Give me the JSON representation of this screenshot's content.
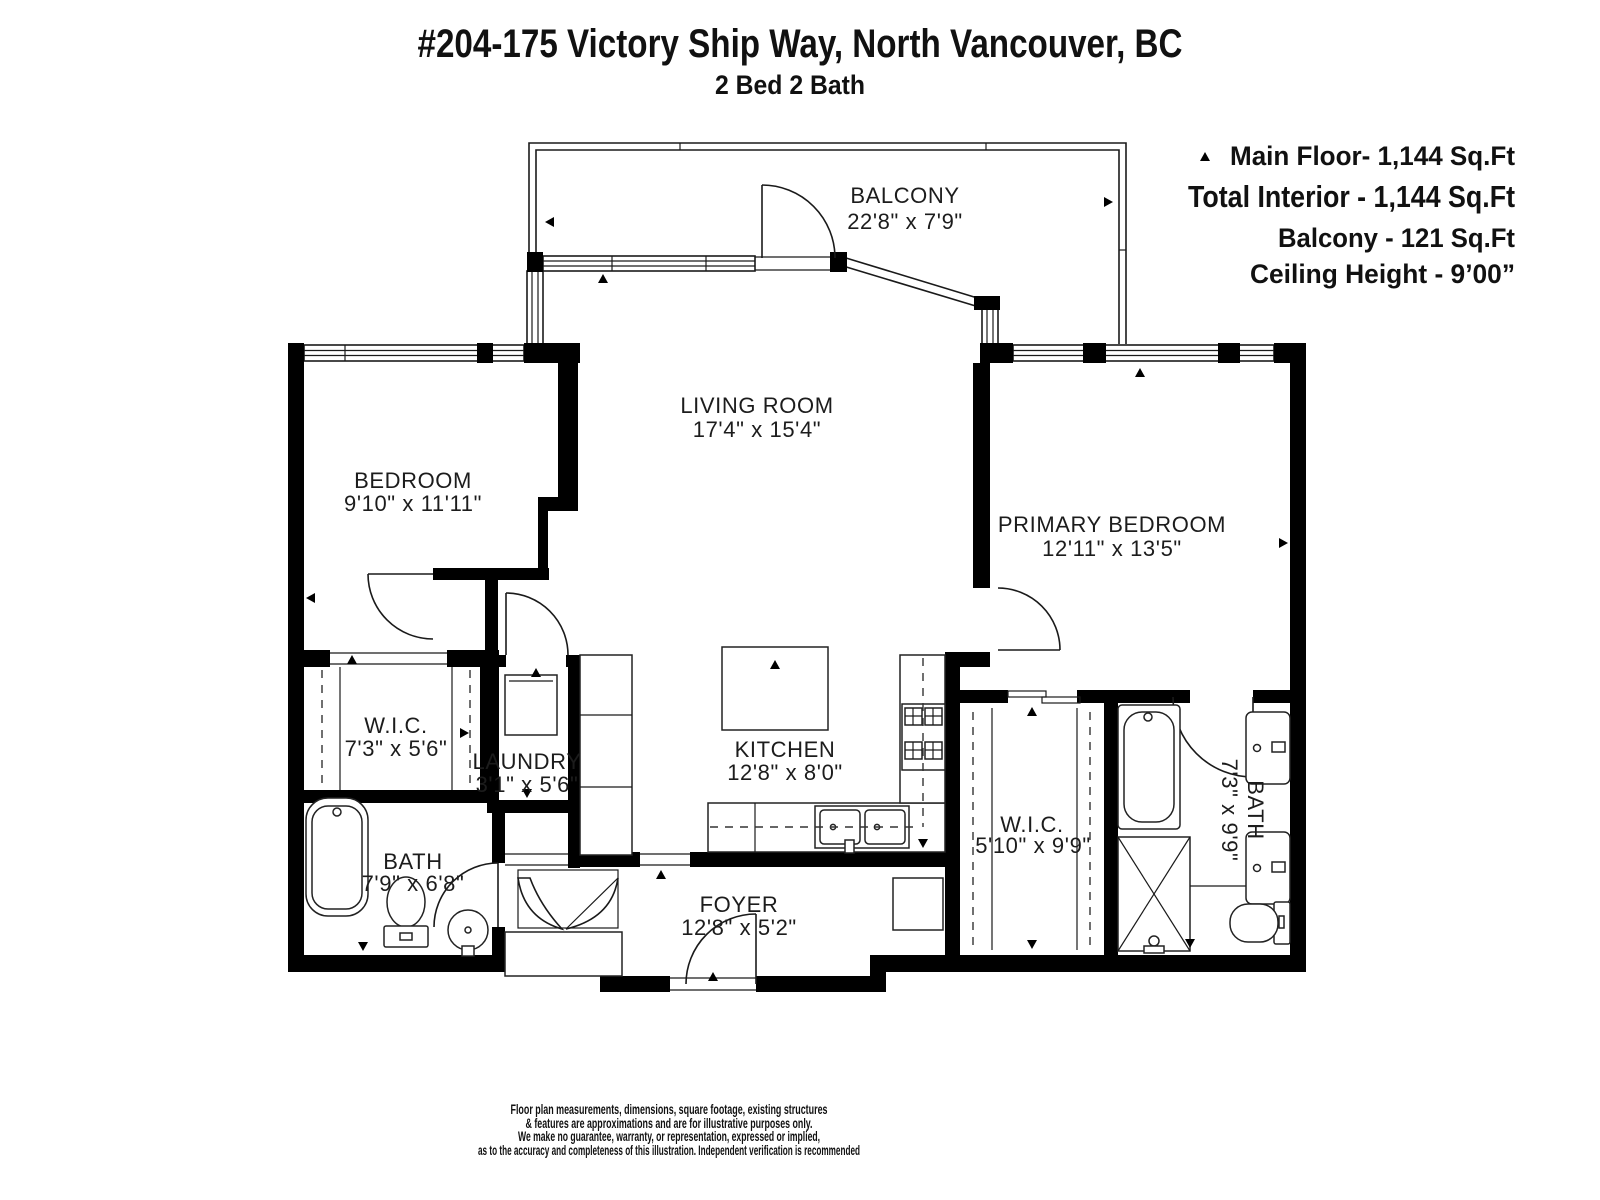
{
  "header": {
    "title": "#204-175 Victory Ship Way, North Vancouver, BC",
    "subtitle": "2 Bed 2 Bath"
  },
  "stats": {
    "main_floor": "Main Floor- 1,144 Sq.Ft",
    "total_interior": "Total Interior - 1,144 Sq.Ft",
    "balcony": "Balcony - 121 Sq.Ft",
    "ceiling_height": "Ceiling Height - 9’00”"
  },
  "rooms": {
    "balcony": {
      "name": "BALCONY",
      "dims": "22'8\" x 7'9\""
    },
    "living": {
      "name": "LIVING ROOM",
      "dims": "17'4\" x 15'4\""
    },
    "bedroom": {
      "name": "BEDROOM",
      "dims": "9'10\" x 11'11\""
    },
    "primary": {
      "name": "PRIMARY BEDROOM",
      "dims": "12'11\" x 13'5\""
    },
    "wic_left": {
      "name": "W.I.C.",
      "dims": "7'3\" x 5'6\""
    },
    "laundry": {
      "name": "LAUNDRY",
      "dims": "3'1\" x 5'6\""
    },
    "kitchen": {
      "name": "KITCHEN",
      "dims": "12'8\" x 8'0\""
    },
    "bath_left": {
      "name": "BATH",
      "dims": "7'9\" x 6'8\""
    },
    "foyer": {
      "name": "FOYER",
      "dims": "12'8\" x 5'2\""
    },
    "wic_right": {
      "name": "W.I.C.",
      "dims": "5'10\" x 9'9\""
    },
    "bath_right": {
      "name": "BATH",
      "dims": "7'3\" x 9'9\""
    }
  },
  "footer": {
    "line1": "Floor plan measurements, dimensions, square footage, existing structures",
    "line2": "& features are approximations and are for illustrative purposes only.",
    "line3": "We make no guarantee, warranty, or representation, expressed or implied,",
    "line4": "as to the accuracy and completeness of this illustration. Independent verification is recommended"
  },
  "colors": {
    "wall": "#000000",
    "line": "#1a1a1a",
    "background": "#ffffff"
  }
}
